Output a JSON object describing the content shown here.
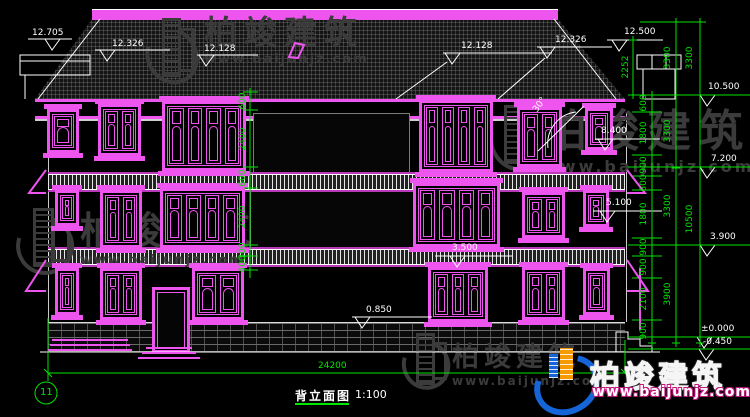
{
  "titleblock": {
    "title": "背立面图",
    "scale": "1:100",
    "sheet": "11"
  },
  "watermark": {
    "brand": "柏竣建筑",
    "url": "www.baijunjz.com"
  },
  "colors": {
    "dim_green": "#00e400",
    "magenta": "#ee55ee",
    "logo_blue": "#1565d8",
    "logo_orange": "#f59a00"
  },
  "elevations": {
    "parapet_top": "12.705",
    "left_eave_ridge": "12.326",
    "left_ridge": "12.128",
    "center_ridge": "12.128",
    "center_eave_ridge": "12.326",
    "main_ridge": "12.500",
    "main_eave": "10.500",
    "wing_eave": "8.400",
    "third_floor": "7.200",
    "second_sill": "5.100",
    "second_floor": "3.900",
    "balcony_rail": "3.500",
    "first_sill": "0.850",
    "ground": "±0.000",
    "footing": "-0.450"
  },
  "angles": {
    "roof_pitch": "30°"
  },
  "dims": {
    "chimney": "2252",
    "right_inner": [
      "600",
      "1800",
      "900",
      "600",
      "1800",
      "900",
      "900",
      "2100",
      "900"
    ],
    "right_floors": [
      "3300",
      "3300",
      "3300",
      "3900"
    ],
    "right_roof": "3300",
    "right_total": "10500",
    "window_chain": [
      "600",
      "2400",
      "600",
      "2400",
      "300",
      "400"
    ],
    "total_width": "24200"
  }
}
